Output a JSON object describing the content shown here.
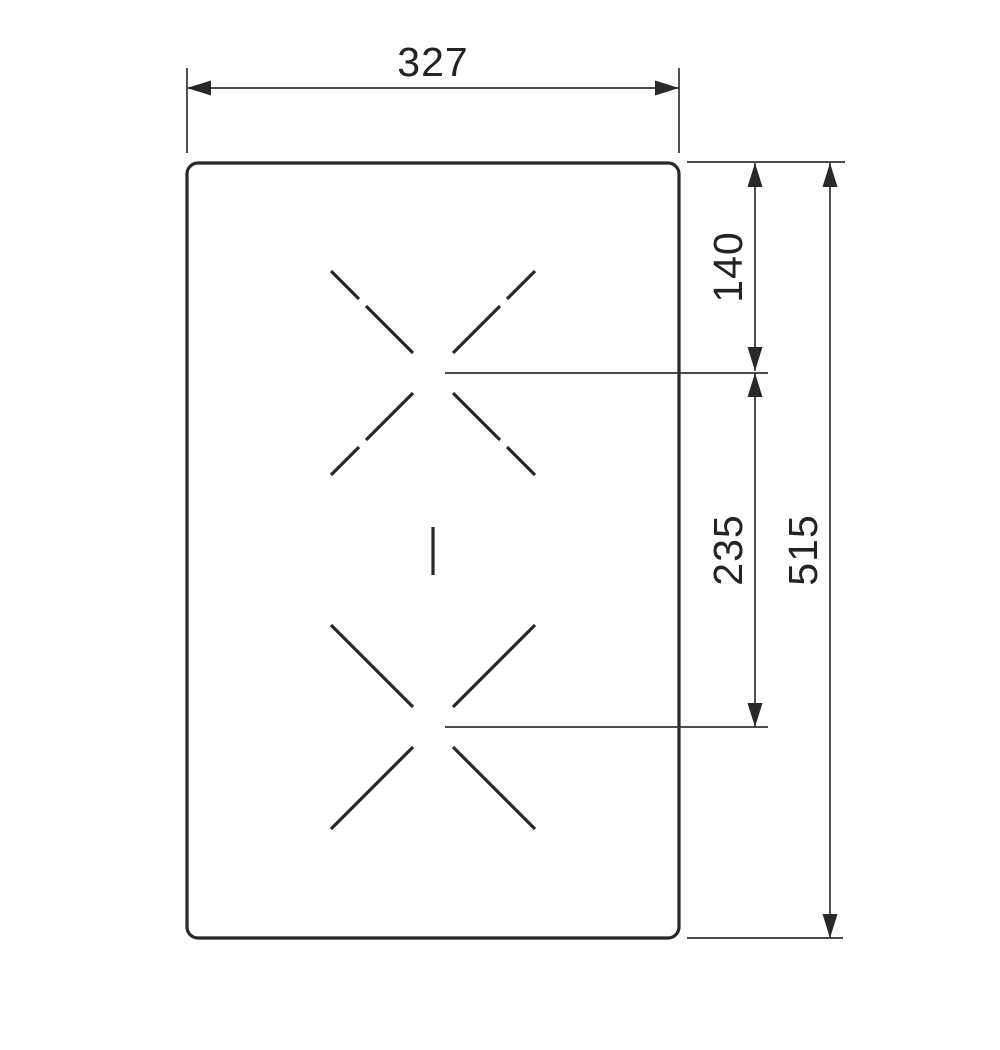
{
  "diagram": {
    "type": "dimension-drawing",
    "subject": "cooktop cutout / hob top view with two cooking-zone crosses",
    "background_color": "#ffffff",
    "line_color": "#26282a",
    "dimensions": {
      "width_top": {
        "value": "327",
        "orientation": "horizontal",
        "measures": "overall width of panel"
      },
      "top_edge_to_upper_zone": {
        "value": "140",
        "orientation": "vertical",
        "measures": "top edge to upper zone center"
      },
      "zone_center_to_center": {
        "value": "235",
        "orientation": "vertical",
        "measures": "upper zone center to lower zone center"
      },
      "height_overall": {
        "value": "515",
        "orientation": "vertical",
        "measures": "overall height of panel"
      }
    },
    "markers": {
      "upper_zone": "dashed X cross",
      "lower_zone": "solid X cross",
      "mid_marker": "short vertical tick"
    }
  }
}
